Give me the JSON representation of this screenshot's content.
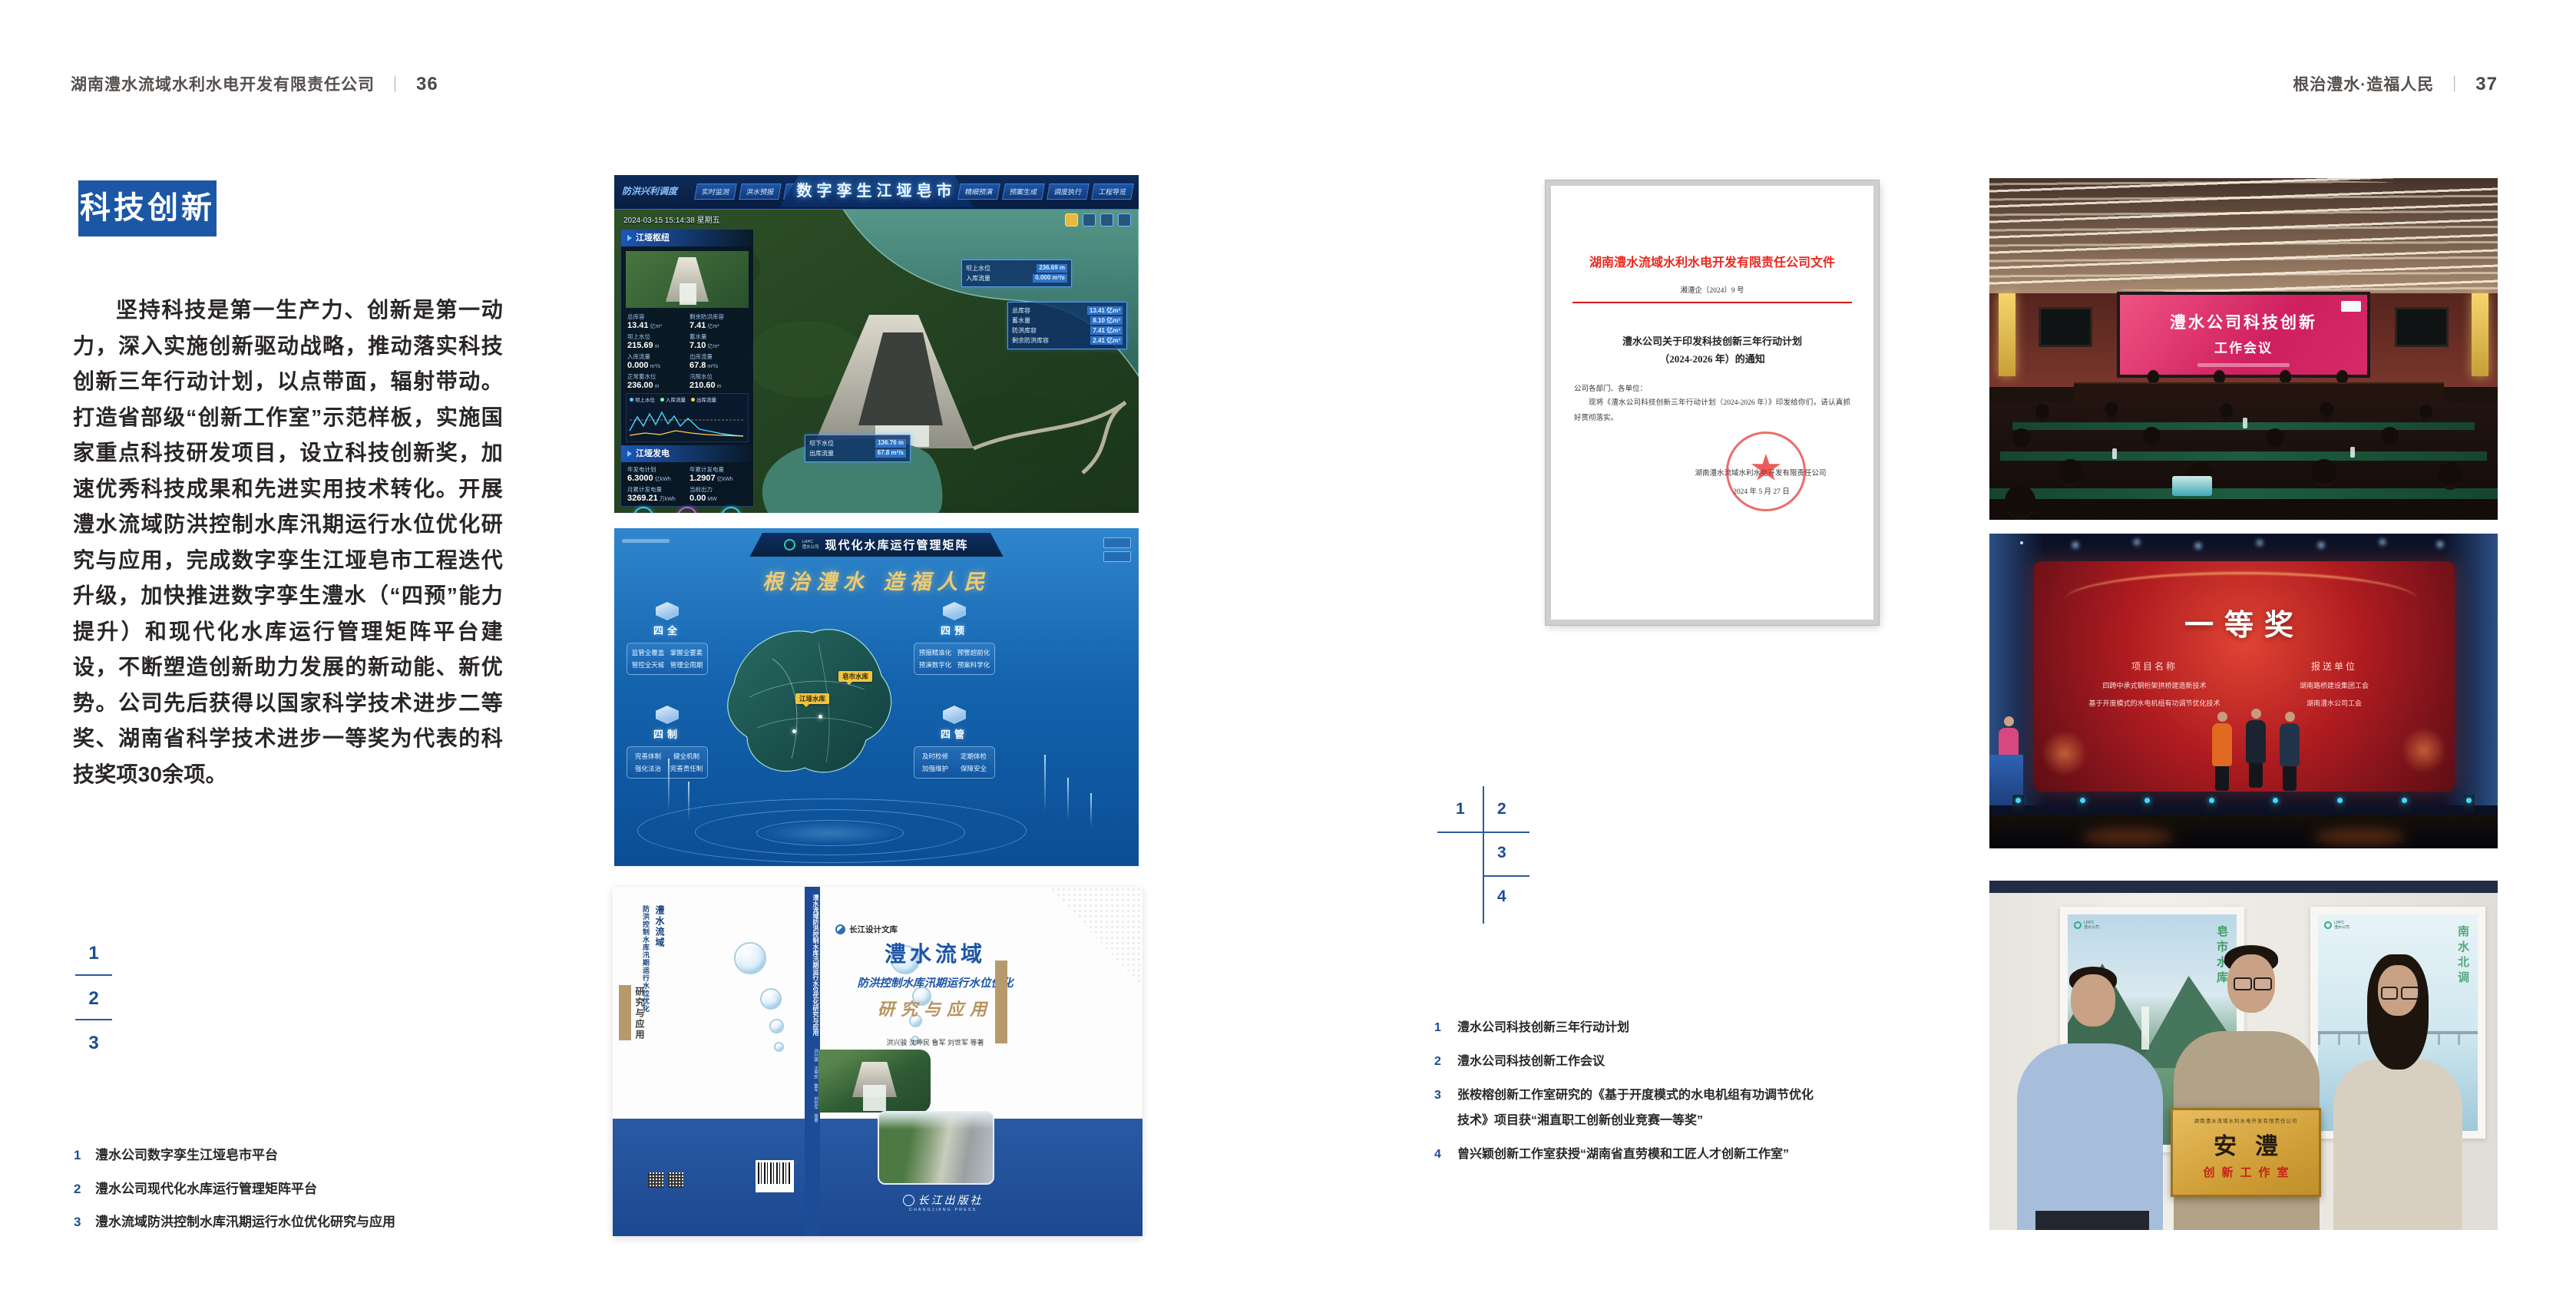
{
  "header_left": {
    "company": "湖南澧水流域水利水电开发有限责任公司",
    "separator": "｜",
    "page": "36"
  },
  "header_right": {
    "motto": "根治澧水·造福人民",
    "separator": "｜",
    "page": "37"
  },
  "left_page": {
    "badge": "科技创新",
    "paragraph": "坚持科技是第一生产力、创新是第一动力，深入实施创新驱动战略，推动落实科技创新三年行动计划，以点带面，辐射带动。打造省部级“创新工作室”示范样板，实施国家重点科技研发项目，设立科技创新奖，加速优秀科技成果和先进实用技术转化。开展澧水流域防洪控制水库汛期运行水位优化研究与应用，完成数字孪生江垭皂市工程迭代升级，加快推进数字孪生澧水（“四预”能力提升）和现代化水库运行管理矩阵平台建设，不断塑造创新助力发展的新动能、新优势。公司先后获得以国家科学技术进步二等奖、湖南省科学技术进步一等奖为代表的科技奖项30余项。",
    "keys": [
      "1",
      "2",
      "3"
    ],
    "captions": [
      {
        "n": "1",
        "t": "澧水公司数字孪生江垭皂市平台"
      },
      {
        "n": "2",
        "t": "澧水公司现代化水库运行管理矩阵平台"
      },
      {
        "n": "3",
        "t": "澧水流域防洪控制水库汛期运行水位优化研究与应用"
      }
    ]
  },
  "right_page": {
    "keys": [
      "1",
      "2",
      "3",
      "4"
    ],
    "captions": [
      {
        "n": "1",
        "t": "澧水公司科技创新三年行动计划"
      },
      {
        "n": "2",
        "t": "澧水公司科技创新工作会议"
      },
      {
        "n": "3",
        "t": "张桉榕创新工作室研究的《基于开度模式的水电机组有功调节优化技术》项目获“湘直职工创新创业竞赛一等奖”"
      },
      {
        "n": "4",
        "t": "曾兴颖创新工作室获授“湖南省直劳模和工匠人才创新工作室”"
      }
    ]
  },
  "digital_twin": {
    "corner_label": "防洪兴利调度",
    "title": "数字孪生江垭皂市",
    "datetime": "2024-03-15 15:14:38 星期五",
    "tabs_left": [
      "实时监测",
      "洪水预报",
      "防洪预警"
    ],
    "tabs_right": [
      "精细预演",
      "预案生成",
      "调度执行",
      "工程导览"
    ],
    "panel_hub_title": "江垭枢纽",
    "hub_stats": [
      {
        "label": "总库容",
        "value": "13.41",
        "unit": "亿m³"
      },
      {
        "label": "剩余防洪库容",
        "value": "7.41",
        "unit": "亿m³"
      },
      {
        "label": "坝上水位",
        "value": "215.69",
        "unit": "m"
      },
      {
        "label": "蓄水量",
        "value": "7.10",
        "unit": "亿m³"
      },
      {
        "label": "入库流量",
        "value": "0.000",
        "unit": "m³/s"
      },
      {
        "label": "出库流量",
        "value": "67.8",
        "unit": "m³/s"
      },
      {
        "label": "正常蓄水位",
        "value": "236.00",
        "unit": "m"
      },
      {
        "label": "汛限水位",
        "value": "210.60",
        "unit": "m"
      }
    ],
    "chart_legend": [
      "坝上水位",
      "入库流量",
      "出库流量"
    ],
    "panel_power_title": "江垭发电",
    "power_stats": [
      {
        "label": "年发电计划",
        "value": "6.3000",
        "unit": "亿kWh"
      },
      {
        "label": "年累计发电量",
        "value": "1.2907",
        "unit": "亿kWh"
      },
      {
        "label": "月累计发电量",
        "value": "3269.21",
        "unit": "万kWh"
      },
      {
        "label": "当前出力",
        "value": "0.00",
        "unit": "MW"
      }
    ],
    "callout_up": [
      {
        "label": "坝上水位",
        "value": "236.69 m"
      },
      {
        "label": "入库流量",
        "value": "0.000 m³/s"
      }
    ],
    "callout_cap": [
      {
        "label": "总库容",
        "value": "13.41 亿m³"
      },
      {
        "label": "蓄水量",
        "value": "8.10 亿m³"
      },
      {
        "label": "防洪库容",
        "value": "7.41 亿m³"
      },
      {
        "label": "剩余防洪库容",
        "value": "2.41 亿m³"
      }
    ],
    "callout_down": [
      {
        "label": "坝下水位",
        "value": "136.76 m"
      },
      {
        "label": "出库流量",
        "value": "67.8 m³/s"
      }
    ]
  },
  "matrix": {
    "logo_abbr": "LHPC",
    "logo_name": "澧水公司",
    "title": "现代化水库运行管理矩阵",
    "slogan": "根治澧水 造福人民",
    "groups": [
      {
        "name": "四全",
        "items": [
          "监管全覆盖",
          "掌握全要素",
          "管控全天候",
          "管理全周期"
        ]
      },
      {
        "name": "四预",
        "items": [
          "预报精准化",
          "预警超前化",
          "预演数字化",
          "预案科学化"
        ]
      },
      {
        "name": "四制",
        "items": [
          "完善体制",
          "健全机制",
          "强化法治",
          "完善责任制"
        ]
      },
      {
        "name": "四管",
        "items": [
          "及时检修",
          "定期体检",
          "加强维护",
          "保障安全"
        ]
      }
    ],
    "marker_1": "皂市水库",
    "marker_2": "江垭水库"
  },
  "book": {
    "series": "长江设计文库",
    "title_main": "澧水流域",
    "title_sub": "防洪控制水库汛期运行水位优化",
    "title_tail": "研究与应用",
    "authors": "洪兴骏 沈坤民 鲁军 刘世军 等著",
    "publisher": "长江出版社",
    "publisher_en": "CHANGJIANG PRESS",
    "spine_title": "澧水流域防洪控制水库汛期运行水位优化研究与应用",
    "back_col_1": "澧水流域",
    "back_col_2": "防洪控制水库汛期运行水位优化",
    "back_tail": "研究与应用"
  },
  "document": {
    "header": "湖南澧水流域水利水电开发有限责任公司文件",
    "doc_no": "湘澧企〔2024〕9 号",
    "title_1": "澧水公司关于印发科技创新三年行动计划",
    "title_2": "（2024-2026 年）的通知",
    "salutation": "公司各部门、各单位：",
    "body": "现将《澧水公司科技创新三年行动计划（2024-2026 年）》印发给你们，请认真抓好贯彻落实。",
    "signer": "湖南澧水流域水利水电开发有限责任公司",
    "date": "2024 年 5 月 27 日"
  },
  "meeting": {
    "screen_line1": "澧水公司科技创新",
    "screen_line2": "工作会议"
  },
  "award": {
    "title": "一等奖",
    "col_project": "项目名称",
    "col_org": "报送单位",
    "rows": [
      {
        "project": "四跨中承式钢桁架拱桥建造新技术",
        "org": "湖南路桥建设集团工会"
      },
      {
        "project": "基于开度模式的水电机组有功调节优化技术",
        "org": "湖南澧水公司工会"
      }
    ]
  },
  "plaque": {
    "org": "湖南澧水流域水利水电开发有限责任公司",
    "name": "安澧",
    "sub": "创新工作室",
    "poster_left": "皂市水库",
    "poster_right": "南水北调"
  },
  "colors": {
    "badge_blue": "#1c57a5",
    "key_blue": "#1d4c91",
    "doc_red": "#e60012",
    "band_blue": "#24539e",
    "gold": "#e6c36d"
  }
}
